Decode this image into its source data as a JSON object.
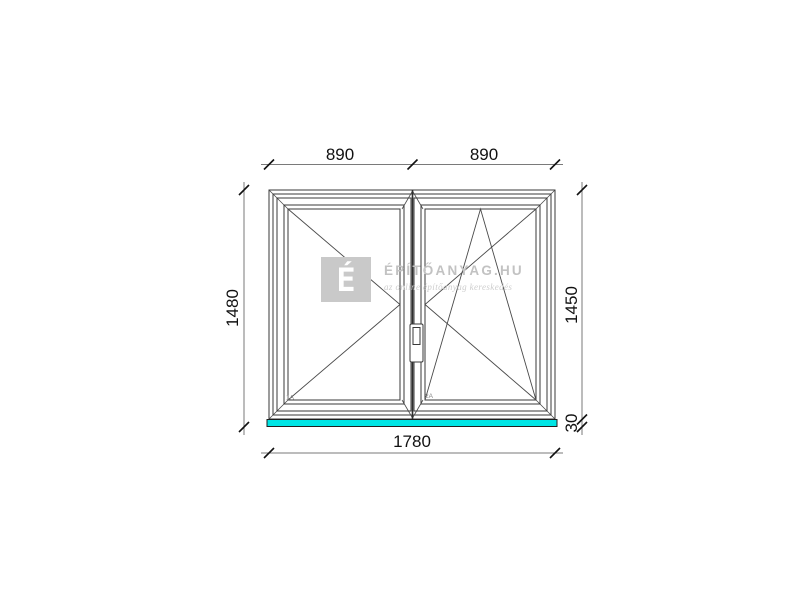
{
  "dimensions": {
    "top_left_width": "890",
    "top_right_width": "890",
    "total_width": "1780",
    "left_total_height": "1480",
    "right_frame_height": "1450",
    "sill_height": "30"
  },
  "pane_labels": {
    "left": "1A",
    "right": "2A"
  },
  "watermark": {
    "logo_letter": "É",
    "title": "ÉPÍTŐANYAG.HU",
    "subtitle": "az online építőanyag kereskedés"
  },
  "drawing_info": {
    "left_sash_opening": "side-hung-turn-indicator",
    "right_sash_opening": "tilt-and-turn-indicator"
  },
  "colors": {
    "sill_cyan": "#00e5e5",
    "frame_line": "#3a3a3a",
    "dimension_line": "#7a7a7a",
    "dimension_text": "#111111",
    "watermark_gray": "#c9c9c9",
    "watermark_text": "#c2c2c2"
  }
}
